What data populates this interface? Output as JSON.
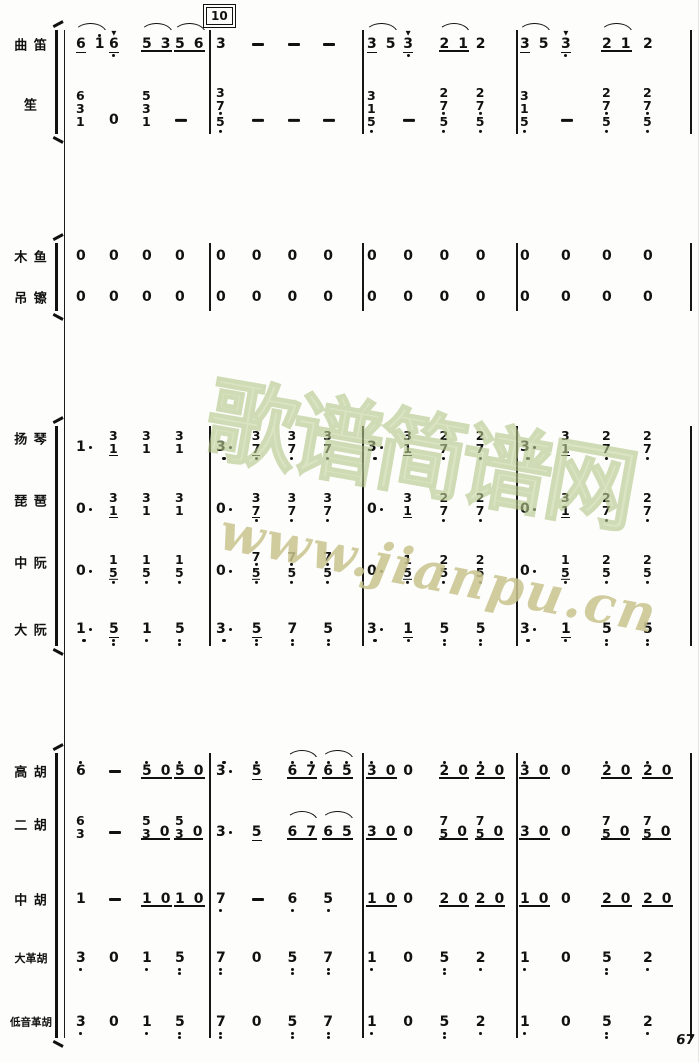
{
  "page": {
    "number": "67",
    "rehearsal_mark": "10",
    "watermark_line1": "歌谱简谱网",
    "watermark_line2": "www.jianpu.cn",
    "ink_color": "#141414",
    "background_color": "#fcfcfa",
    "watermark_green": "#c6d5a0",
    "watermark_tan": "#d8c98e"
  },
  "_encoding": "Each cell 'n' holds space-separated note tokens; '/'=chord stack top-to-bottom; '''=octave dot above; ','=octave dot below; '.'=augmentation dot; '_'=underline (eighth); '!'=accent; '-'=held-beat dash; cell flag u=continuous underline, s=slur arc.",
  "layout": {
    "score_left": 68,
    "measure_lefts": [
      68,
      210,
      363,
      518
    ],
    "measure_widths": [
      140,
      151,
      153,
      172
    ],
    "barlines_x": [
      209,
      362,
      516,
      690
    ],
    "system_line": {
      "x": 64,
      "top": 30,
      "bottom": 1038
    },
    "bracket_x": 55
  },
  "groups": [
    {
      "id": "winds",
      "top": 30,
      "bottom": 134,
      "staves": [
        {
          "id": "qudi",
          "label": "曲 笛",
          "y": 44,
          "measures": [
            [
              {
                "n": "6_ 1'",
                "s": 1
              },
              {
                "n": "6_,!"
              },
              {
                "n": "5 3",
                "u": 1,
                "s": 1
              },
              {
                "n": "5 6",
                "u": 1,
                "s": 1
              }
            ],
            [
              {
                "n": "3"
              },
              {
                "n": "-"
              },
              {
                "n": "-"
              },
              {
                "n": "-"
              }
            ],
            [
              {
                "n": "3_ 5",
                "s": 1
              },
              {
                "n": "3_,!"
              },
              {
                "n": "2 1",
                "u": 1,
                "s": 1
              },
              {
                "n": "2"
              }
            ],
            [
              {
                "n": "3_ 5",
                "s": 1
              },
              {
                "n": "3_,!"
              },
              {
                "n": "2 1",
                "u": 1,
                "s": 1
              },
              {
                "n": "2"
              }
            ]
          ]
        },
        {
          "id": "sheng",
          "label": "笙",
          "y": 120,
          "ly": 104,
          "measures": [
            [
              {
                "n": "6/3/1"
              },
              {
                "n": "0"
              },
              {
                "n": "5/3/1"
              },
              {
                "n": "-"
              }
            ],
            [
              {
                "n": "3/7,/5,"
              },
              {
                "n": "-"
              },
              {
                "n": "-"
              },
              {
                "n": "-"
              }
            ],
            [
              {
                "n": "3/1/5,"
              },
              {
                "n": "-"
              },
              {
                "n": "2/7,/5,"
              },
              {
                "n": "2/7,/5,"
              }
            ],
            [
              {
                "n": "3/1/5,"
              },
              {
                "n": "-"
              },
              {
                "n": "2/7,/5,"
              },
              {
                "n": "2/7,/5,"
              }
            ]
          ]
        }
      ]
    },
    {
      "id": "percussion",
      "top": 243,
      "bottom": 311,
      "staves": [
        {
          "id": "muyu",
          "label": "木 鱼",
          "y": 256,
          "measures": [
            [
              {
                "n": "0"
              },
              {
                "n": "0"
              },
              {
                "n": "0"
              },
              {
                "n": "0"
              }
            ],
            [
              {
                "n": "0"
              },
              {
                "n": "0"
              },
              {
                "n": "0"
              },
              {
                "n": "0"
              }
            ],
            [
              {
                "n": "0"
              },
              {
                "n": "0"
              },
              {
                "n": "0"
              },
              {
                "n": "0"
              }
            ],
            [
              {
                "n": "0"
              },
              {
                "n": "0"
              },
              {
                "n": "0"
              },
              {
                "n": "0"
              }
            ]
          ]
        },
        {
          "id": "diaocha",
          "label": "吊 镲",
          "y": 297,
          "measures": [
            [
              {
                "n": "0"
              },
              {
                "n": "0"
              },
              {
                "n": "0"
              },
              {
                "n": "0"
              }
            ],
            [
              {
                "n": "0"
              },
              {
                "n": "0"
              },
              {
                "n": "0"
              },
              {
                "n": "0"
              }
            ],
            [
              {
                "n": "0"
              },
              {
                "n": "0"
              },
              {
                "n": "0"
              },
              {
                "n": "0"
              }
            ],
            [
              {
                "n": "0"
              },
              {
                "n": "0"
              },
              {
                "n": "0"
              },
              {
                "n": "0"
              }
            ]
          ]
        }
      ]
    },
    {
      "id": "plucked",
      "top": 426,
      "bottom": 646,
      "staves": [
        {
          "id": "yangqin",
          "label": "扬 琴",
          "y": 447,
          "ly": 438,
          "measures": [
            [
              {
                "n": "1."
              },
              {
                "n": "3/1_"
              },
              {
                "n": "3/1"
              },
              {
                "n": "3/1"
              }
            ],
            [
              {
                "n": "3,."
              },
              {
                "n": "3/7,_"
              },
              {
                "n": "3/7,"
              },
              {
                "n": "3/7,"
              }
            ],
            [
              {
                "n": "3,."
              },
              {
                "n": "3/1_"
              },
              {
                "n": "2/7,"
              },
              {
                "n": "2/7,"
              }
            ],
            [
              {
                "n": "3,."
              },
              {
                "n": "3/1_"
              },
              {
                "n": "2/7,"
              },
              {
                "n": "2/7,"
              }
            ]
          ]
        },
        {
          "id": "pipa",
          "label": "琵 琶",
          "y": 509,
          "ly": 500,
          "measures": [
            [
              {
                "n": "0."
              },
              {
                "n": "3/1_"
              },
              {
                "n": "3/1"
              },
              {
                "n": "3/1"
              }
            ],
            [
              {
                "n": "0."
              },
              {
                "n": "3/7,_"
              },
              {
                "n": "3/7,"
              },
              {
                "n": "3/7,"
              }
            ],
            [
              {
                "n": "0."
              },
              {
                "n": "3/1_"
              },
              {
                "n": "2/7,"
              },
              {
                "n": "2/7,"
              }
            ],
            [
              {
                "n": "0."
              },
              {
                "n": "3/1_"
              },
              {
                "n": "2/7,"
              },
              {
                "n": "2/7,"
              }
            ]
          ]
        },
        {
          "id": "zhongruan",
          "label": "中 阮",
          "y": 571,
          "ly": 562,
          "measures": [
            [
              {
                "n": "0."
              },
              {
                "n": "1/5,_"
              },
              {
                "n": "1/5,"
              },
              {
                "n": "1/5,"
              }
            ],
            [
              {
                "n": "0."
              },
              {
                "n": "7,/5,_"
              },
              {
                "n": "7,/5,"
              },
              {
                "n": "7,/5,"
              }
            ],
            [
              {
                "n": "0."
              },
              {
                "n": "1/5,_"
              },
              {
                "n": "2/5,"
              },
              {
                "n": "2/5,"
              }
            ],
            [
              {
                "n": "0."
              },
              {
                "n": "1/5,_"
              },
              {
                "n": "2/5,"
              },
              {
                "n": "2/5,"
              }
            ]
          ]
        },
        {
          "id": "daruan",
          "label": "大 阮",
          "y": 629,
          "measures": [
            [
              {
                "n": "1,."
              },
              {
                "n": "5,,_"
              },
              {
                "n": "1,"
              },
              {
                "n": "5,,"
              }
            ],
            [
              {
                "n": "3,."
              },
              {
                "n": "5,,_"
              },
              {
                "n": "7,,"
              },
              {
                "n": "5,,"
              }
            ],
            [
              {
                "n": "3,."
              },
              {
                "n": "1,_"
              },
              {
                "n": "5,,"
              },
              {
                "n": "5,,"
              }
            ],
            [
              {
                "n": "3,."
              },
              {
                "n": "1,_"
              },
              {
                "n": "5,,"
              },
              {
                "n": "5,,"
              }
            ]
          ]
        }
      ]
    },
    {
      "id": "bowed",
      "top": 753,
      "bottom": 1038,
      "staves": [
        {
          "id": "gaohu",
          "label": "高 胡",
          "y": 771,
          "measures": [
            [
              {
                "n": "6'"
              },
              {
                "n": "-"
              },
              {
                "n": "5' 0",
                "u": 1
              },
              {
                "n": "5' 0",
                "u": 1
              }
            ],
            [
              {
                "n": "3'."
              },
              {
                "n": "5'_"
              },
              {
                "n": "6' 7'",
                "u": 1,
                "s": 1
              },
              {
                "n": "6' 5'",
                "u": 1,
                "s": 1
              }
            ],
            [
              {
                "n": "3' 0",
                "u": 1
              },
              {
                "n": "0"
              },
              {
                "n": "2' 0",
                "u": 1
              },
              {
                "n": "2' 0",
                "u": 1
              }
            ],
            [
              {
                "n": "3' 0",
                "u": 1
              },
              {
                "n": "0"
              },
              {
                "n": "2' 0",
                "u": 1
              },
              {
                "n": "2' 0",
                "u": 1
              }
            ]
          ]
        },
        {
          "id": "erhu",
          "label": "二 胡",
          "y": 832,
          "ly": 824,
          "measures": [
            [
              {
                "n": "6/3"
              },
              {
                "n": "-"
              },
              {
                "n": "5/3 0",
                "u": 1
              },
              {
                "n": "5/3 0",
                "u": 1
              }
            ],
            [
              {
                "n": "3."
              },
              {
                "n": "5_"
              },
              {
                "n": "6 7",
                "u": 1,
                "s": 1
              },
              {
                "n": "6 5",
                "u": 1,
                "s": 1
              }
            ],
            [
              {
                "n": "3 0",
                "u": 1
              },
              {
                "n": "0"
              },
              {
                "n": "7/5 0",
                "u": 1
              },
              {
                "n": "7/5 0",
                "u": 1
              }
            ],
            [
              {
                "n": "3 0",
                "u": 1
              },
              {
                "n": "0"
              },
              {
                "n": "7/5 0",
                "u": 1
              },
              {
                "n": "7/5 0",
                "u": 1
              }
            ]
          ]
        },
        {
          "id": "zhonghu",
          "label": "中 胡",
          "y": 899,
          "measures": [
            [
              {
                "n": "1"
              },
              {
                "n": "-"
              },
              {
                "n": "1 0",
                "u": 1
              },
              {
                "n": "1 0",
                "u": 1
              }
            ],
            [
              {
                "n": "7,"
              },
              {
                "n": "-"
              },
              {
                "n": "6,"
              },
              {
                "n": "5,"
              }
            ],
            [
              {
                "n": "1 0",
                "u": 1
              },
              {
                "n": "0"
              },
              {
                "n": "2 0",
                "u": 1
              },
              {
                "n": "2 0",
                "u": 1
              }
            ],
            [
              {
                "n": "1 0",
                "u": 1
              },
              {
                "n": "0"
              },
              {
                "n": "2 0",
                "u": 1
              },
              {
                "n": "2 0",
                "u": 1
              }
            ]
          ]
        },
        {
          "id": "dagehu",
          "label": "大革胡",
          "y": 958,
          "measures": [
            [
              {
                "n": "3,"
              },
              {
                "n": "0"
              },
              {
                "n": "1,"
              },
              {
                "n": "5,,"
              }
            ],
            [
              {
                "n": "7,,"
              },
              {
                "n": "0"
              },
              {
                "n": "5,,"
              },
              {
                "n": "7,,"
              }
            ],
            [
              {
                "n": "1,"
              },
              {
                "n": "0"
              },
              {
                "n": "5,,"
              },
              {
                "n": "2,"
              }
            ],
            [
              {
                "n": "1,"
              },
              {
                "n": "0"
              },
              {
                "n": "5,,"
              },
              {
                "n": "2,"
              }
            ]
          ]
        },
        {
          "id": "diyin-gehu",
          "label": "低音革胡",
          "y": 1022,
          "measures": [
            [
              {
                "n": "3,"
              },
              {
                "n": "0"
              },
              {
                "n": "1,"
              },
              {
                "n": "5,,"
              }
            ],
            [
              {
                "n": "7,,"
              },
              {
                "n": "0"
              },
              {
                "n": "5,,"
              },
              {
                "n": "7,,"
              }
            ],
            [
              {
                "n": "1,"
              },
              {
                "n": "0"
              },
              {
                "n": "5,,"
              },
              {
                "n": "2,"
              }
            ],
            [
              {
                "n": "1,"
              },
              {
                "n": "0"
              },
              {
                "n": "5,,"
              },
              {
                "n": "2,"
              }
            ]
          ]
        }
      ]
    }
  ]
}
